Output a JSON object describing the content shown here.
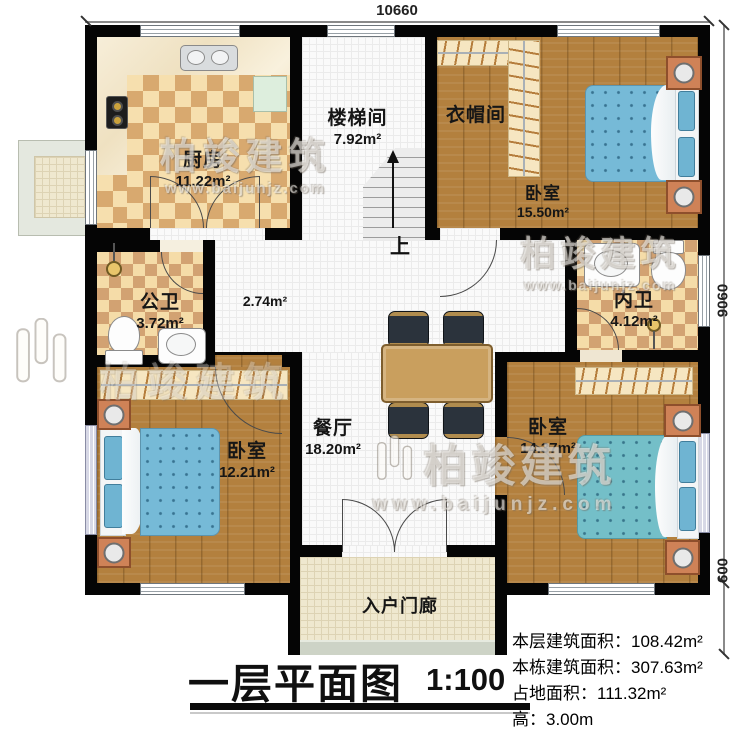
{
  "title": {
    "name": "一层平面图",
    "scale": "1:100"
  },
  "dimensions": {
    "top": "10660",
    "right": "9060",
    "right_lower": "600"
  },
  "rooms": {
    "kitchen": {
      "name": "厨房",
      "area": "11.22m²"
    },
    "stairwell": {
      "name": "楼梯间",
      "area": "7.92m²"
    },
    "cloakroom": {
      "name": "衣帽间"
    },
    "bedroom_tr": {
      "name": "卧室",
      "area": "15.50m²"
    },
    "public_bath": {
      "name": "公卫",
      "area": "3.72m²"
    },
    "hallway": {
      "area": "2.74m²"
    },
    "ensuite_bath": {
      "name": "内卫",
      "area": "4.12m²"
    },
    "bedroom_bl": {
      "name": "卧室",
      "area": "12.21m²"
    },
    "dining": {
      "name": "餐厅",
      "area": "18.20m²"
    },
    "bedroom_br": {
      "name": "卧室",
      "area": "14.37m²"
    },
    "porch": {
      "name": "入户门廊"
    }
  },
  "stairs": {
    "up": "上"
  },
  "stats": {
    "lines": [
      {
        "label": "本层建筑面积：",
        "value": "108.42m²"
      },
      {
        "label": "本栋建筑面积：",
        "value": "307.63m²"
      },
      {
        "label": "占地面积：",
        "value": "111.32m²"
      },
      {
        "label": "高：",
        "value": "3.00m"
      }
    ]
  },
  "watermark": {
    "brand": "柏竣建筑",
    "url": "www.baijunjz.com"
  },
  "colors": {
    "wall": "#050505",
    "wood": "#b3803e",
    "tile_light": "#f6dfae",
    "tile_dark": "#d8a96f",
    "bed": "#76bad7",
    "accent": "#cf8257"
  }
}
